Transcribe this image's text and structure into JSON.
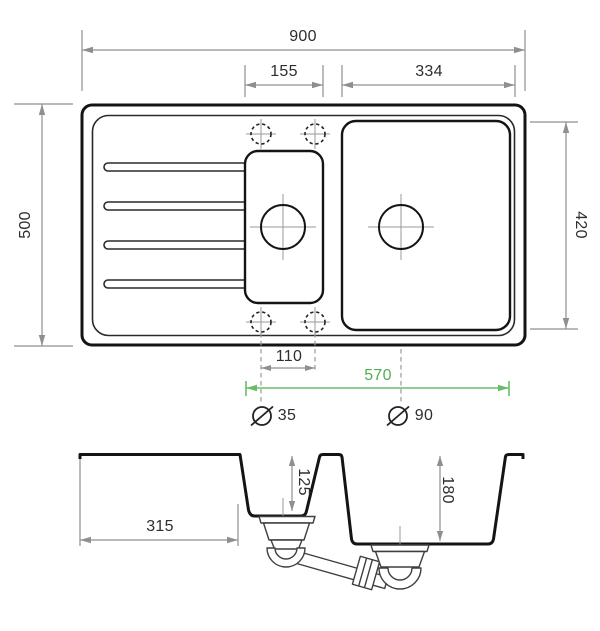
{
  "colors": {
    "background": "#ffffff",
    "outline": "#141414",
    "dimension_line": "#8f8f8f",
    "label_text": "#2e2e2e",
    "accent_green_line": "#68bd6b",
    "accent_green_text": "#4fae53",
    "waste_kit_line": "#3f3f3f"
  },
  "icons": {
    "diameter": "circle-with-slash",
    "tap_hole": "dashed-circle-with-crosshair",
    "drain_hole": "circle-with-crosshair"
  },
  "top_view": {
    "overall_width_mm": "900",
    "overall_depth_mm": "500",
    "small_bowl_width_mm": "155",
    "large_bowl_width_mm": "334",
    "large_bowl_depth_mm": "420",
    "tap_hole_spacing_mm": "110",
    "bowl_span_mm": "570",
    "tap_hole_diameter_mm": "35",
    "drain_diameter_mm": "90"
  },
  "section_view": {
    "drainer_length_mm": "315",
    "small_bowl_depth_mm": "125",
    "large_bowl_depth_mm": "180"
  }
}
